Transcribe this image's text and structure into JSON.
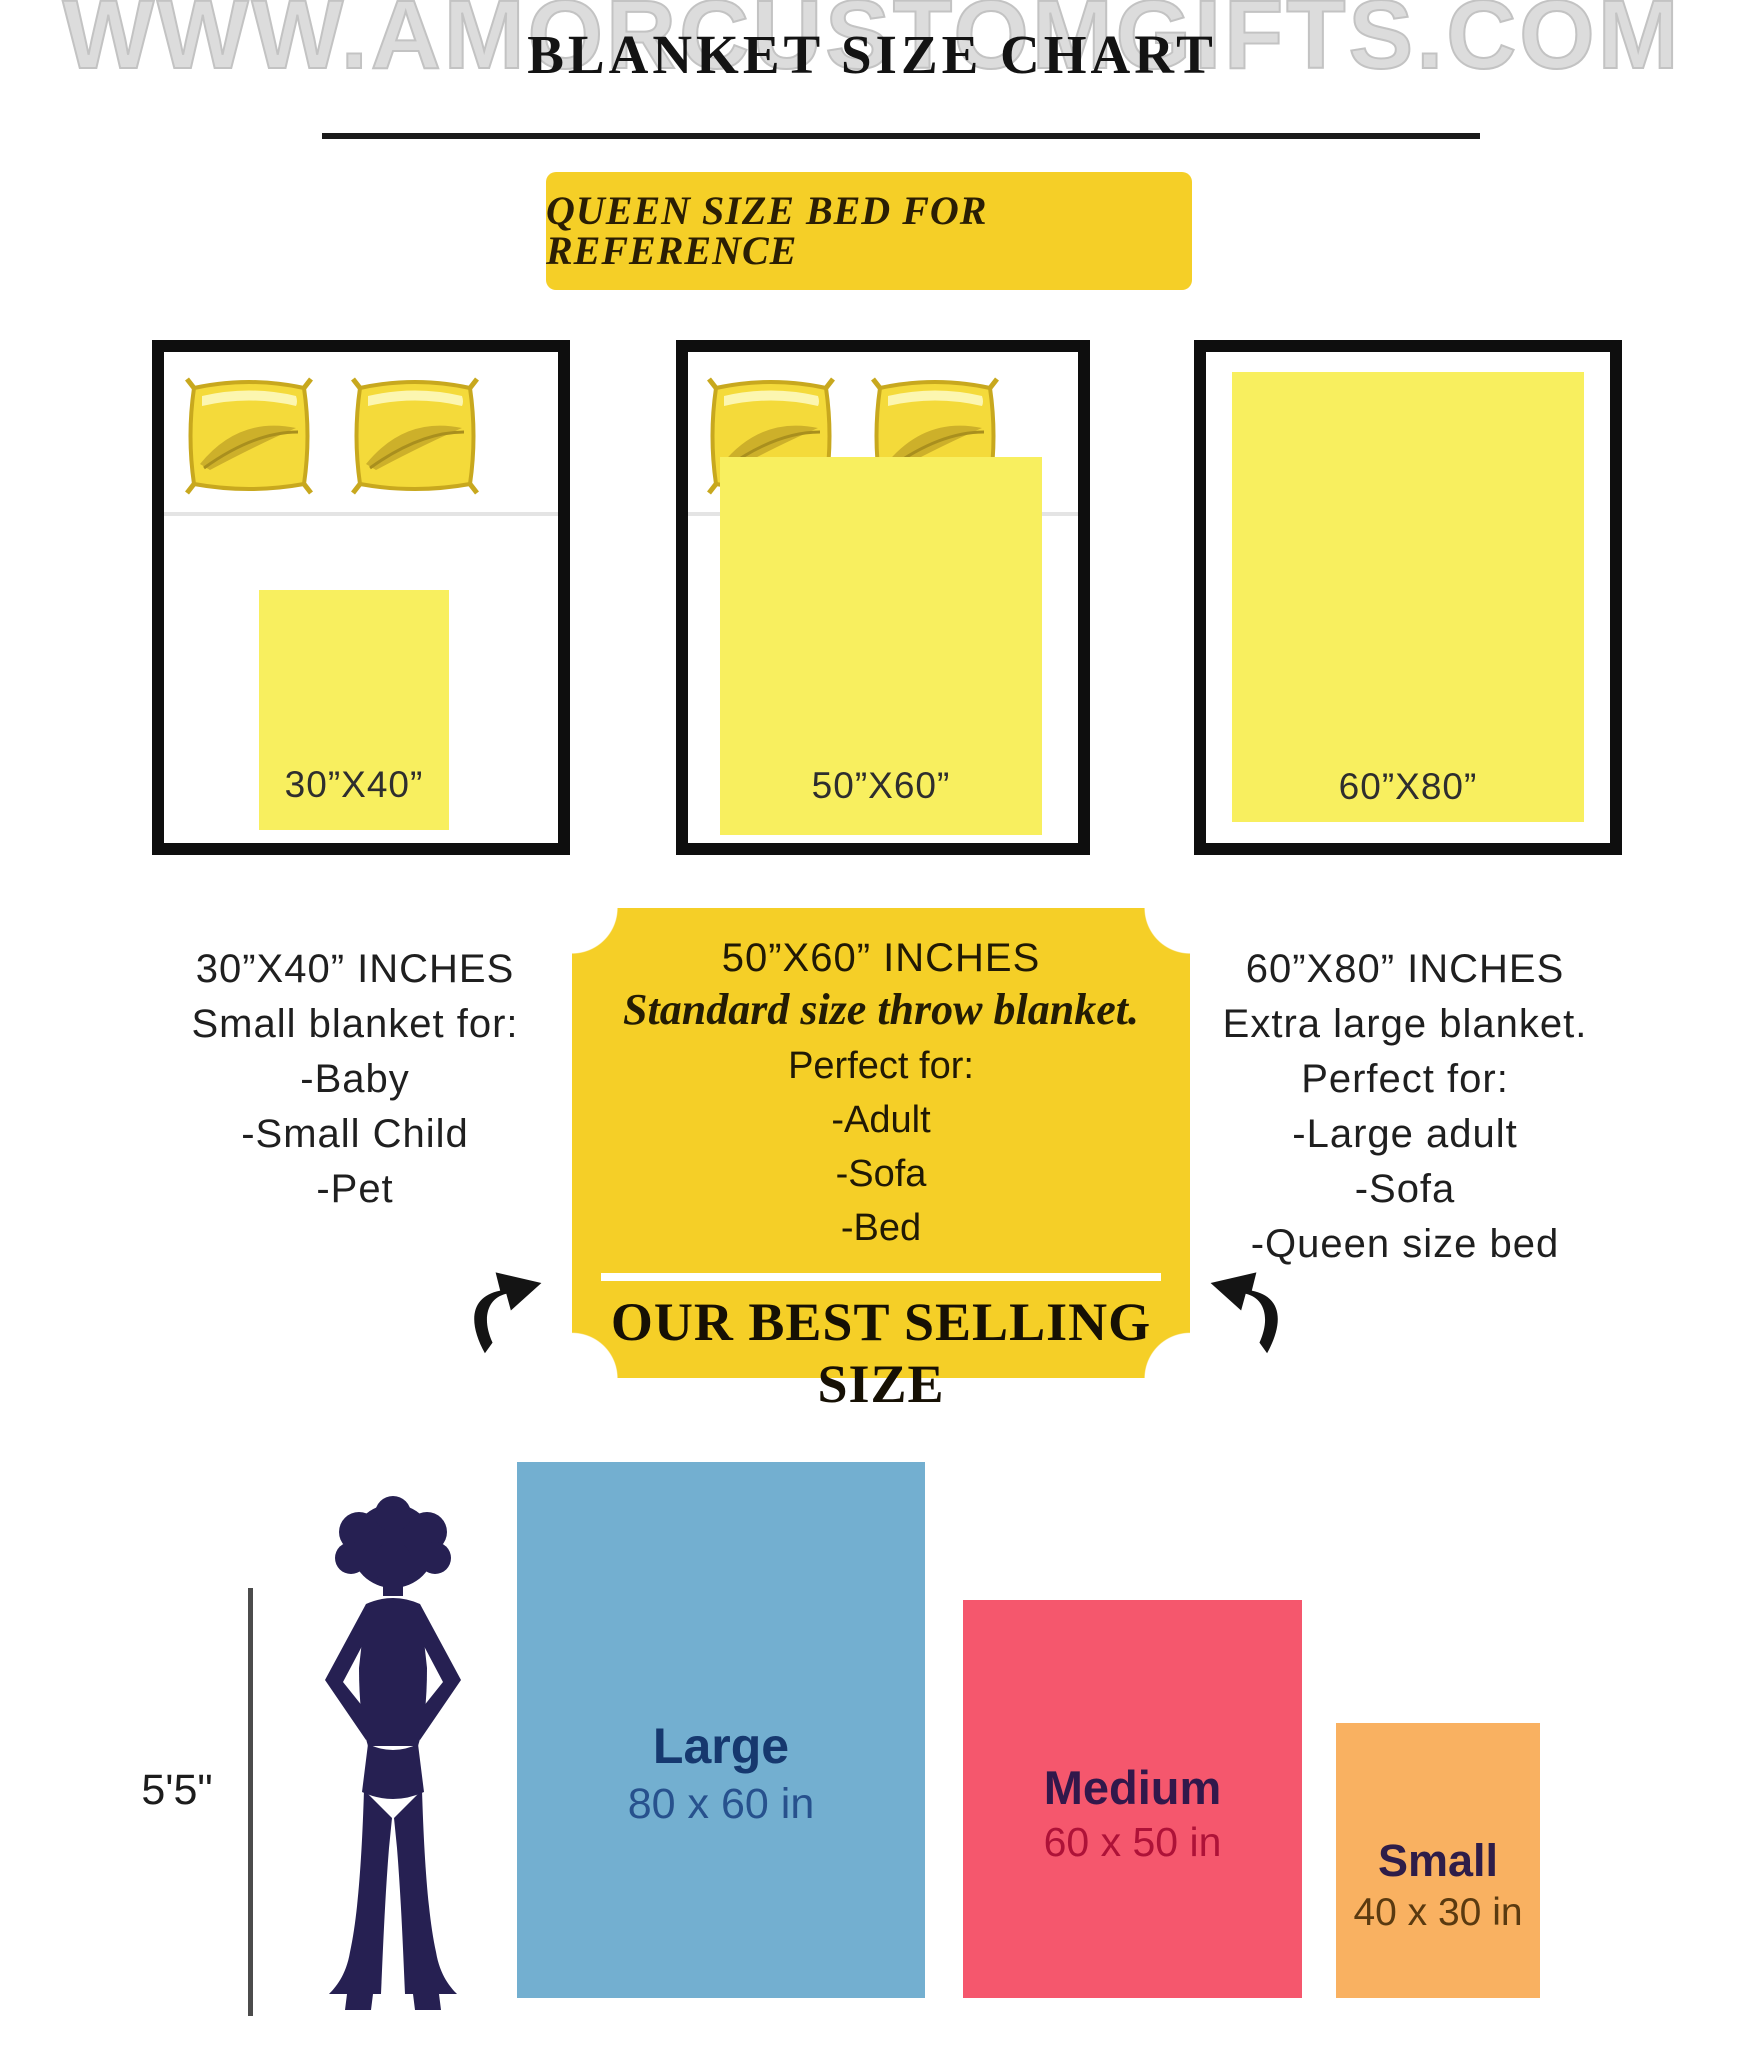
{
  "watermark": "WWW.AMORCUSTOMGIFTS.COM",
  "header": {
    "title": "BLANKET SIZE CHART",
    "banner": "QUEEN SIZE BED FOR REFERENCE"
  },
  "beds": [
    {
      "blanket_label": "30”X40”"
    },
    {
      "blanket_label": "50”X60”"
    },
    {
      "blanket_label": "60”X80”"
    }
  ],
  "columns": {
    "left": {
      "title": "30”X40” INCHES",
      "subtitle": "Small blanket for:",
      "items": [
        "-Baby",
        "-Small Child",
        "-Pet"
      ]
    },
    "center": {
      "title": "50”X60” INCHES",
      "tagline": "Standard size throw blanket.",
      "perfect_for": "Perfect for:",
      "items": [
        "-Adult",
        "-Sofa",
        "-Bed"
      ],
      "highlight": "OUR BEST SELLING SIZE"
    },
    "right": {
      "title": "60”X80” INCHES",
      "subtitle": "Extra large blanket.",
      "perfect_for": "Perfect for:",
      "items": [
        "-Large adult",
        "-Sofa",
        "-Queen size bed"
      ]
    }
  },
  "comparison": {
    "height_label": "5'5\"",
    "blankets": [
      {
        "name": "Large",
        "dims": "80 x 60 in",
        "color": "#73AFD0"
      },
      {
        "name": "Medium",
        "dims": "60 x 50 in",
        "color": "#F5576D"
      },
      {
        "name": "Small",
        "dims": "40 x 30 in",
        "color": "#F9B161"
      }
    ]
  },
  "colors": {
    "accent_gold": "#F5CF27",
    "blanket_yellow": "#F8EF5F",
    "pillow_gold": "#F4DA3A",
    "silhouette_navy": "#262052",
    "watermark_gray": "#DCDCDC"
  }
}
